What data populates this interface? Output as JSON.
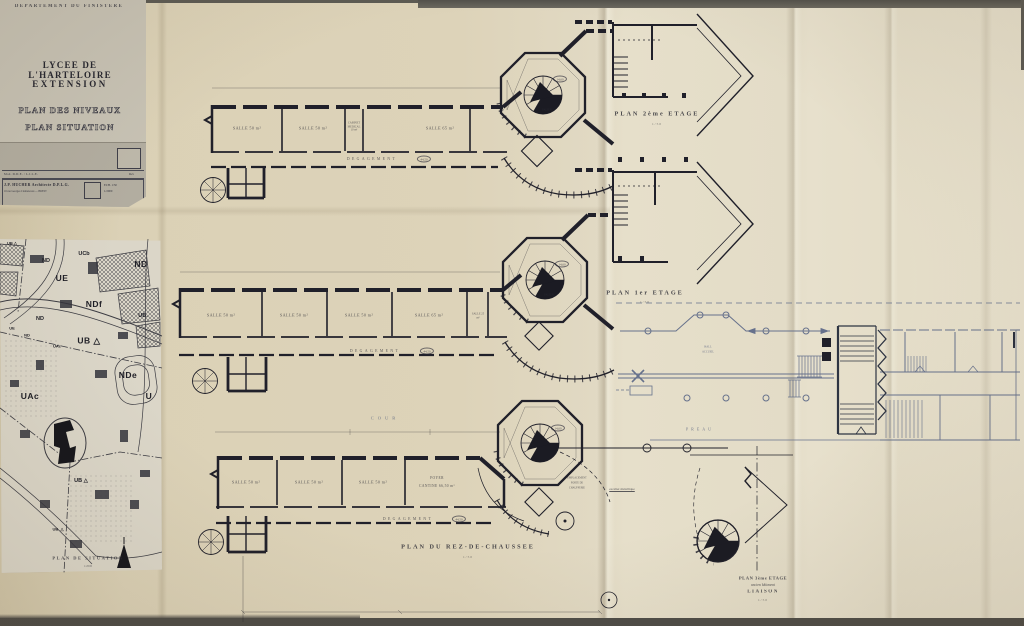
{
  "titlecard": {
    "department": "DEPARTEMENT DU FINISTERE",
    "title1": "LYCEE DE L'HARTELOIRE",
    "title2": "EXTENSION",
    "sub1": "PLAN DES NIVEAUX",
    "sub2": "PLAN SITUATION",
    "ref_row": "Mod. D.D.E. / L.I.L.E.",
    "rev_label": "Rev",
    "architect": "J.P. HUCHER   Architecte D.P.L.G.",
    "address": "16 rue Georges Clemenceau — BREST",
    "ech1": "ECH. 1/50",
    "ech2": "1/2000"
  },
  "sitemap": {
    "caption": "PLAN DE SITUATION",
    "scale": "1/2000",
    "zones": [
      "UB △",
      "ND",
      "UCb",
      "ND",
      "UE",
      "NDf",
      "UB.",
      "ND",
      "UE",
      "ND",
      "UAc",
      "UB △",
      "NDe",
      "UAc",
      "U",
      "UB △",
      "UB. △"
    ]
  },
  "plan2": {
    "caption": "PLAN 2ème ETAGE",
    "scale": "1/50",
    "rooms": [
      "SALLE 50 m²",
      "SALLE 50 m²",
      "CABINET MEDICAL 10 m²",
      "SALLE 65 m²"
    ],
    "corridor": "DEGAGEMENT",
    "corridor_area": "44,50",
    "badge1": "14,60",
    "badge2": "PALIER"
  },
  "plan1": {
    "caption": "PLAN 1er ETAGE",
    "scale": "1/50",
    "rooms": [
      "SALLE 50 m²",
      "SALLE 50 m²",
      "SALLE 50 m²",
      "SALLE 65 m²",
      "SALLE 25 m²"
    ],
    "corridor": "DEGAGEMENT",
    "corridor_area": "44,50",
    "badge1": "14,60",
    "badge2": "PALIER"
  },
  "rdc": {
    "caption": "PLAN DU REZ-DE-CHAUSSEE",
    "scale": "1/50",
    "rooms": [
      "SALLE 50 m²",
      "SALLE 50 m²",
      "SALLE 50 m²"
    ],
    "foyer_l1": "FOYER",
    "foyer_l2": "CANTINE 66,50 m²",
    "corridor": "DEGAGEMENT",
    "corridor_area": "44,50",
    "cour": "COUR",
    "preau": "PREAU",
    "hall1": "HALL",
    "hall2": "ACCUEIL",
    "note_stair": "escalier métallique",
    "note_porte1": "EMPLACEMENT",
    "note_porte2": "PORTE DE",
    "note_porte3": "CHAUFFERIE",
    "badge1": "14,60"
  },
  "plan3": {
    "l1": "PLAN 3ème ETAGE",
    "l2": "ancien bâtiment",
    "l3": "LIAISON",
    "scale": "1/50"
  }
}
